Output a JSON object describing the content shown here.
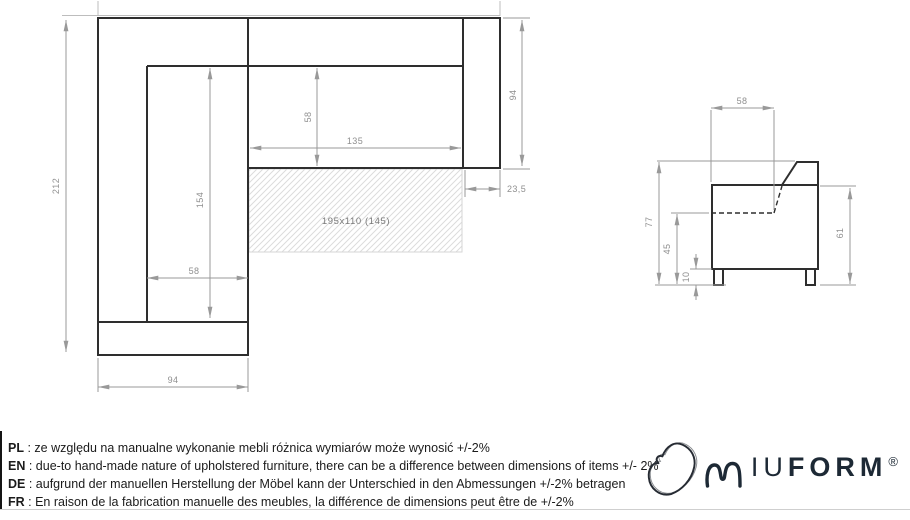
{
  "plan_view": {
    "dim_total_length": "212",
    "dim_chaise_width": "94",
    "dim_chaise_seat_width": "58",
    "dim_chaise_seat_length": "154",
    "dim_seat_width": "135",
    "dim_seat_depth": "58",
    "dim_body_depth": "94",
    "dim_armrest_width": "23,5",
    "sleeping_area_label": "195x110 (145)"
  },
  "side_view": {
    "dim_seat_top_depth": "58",
    "dim_total_height": "77",
    "dim_seat_height": "45",
    "dim_leg_height": "10",
    "dim_arm_height": "61"
  },
  "notes_separator": " : ",
  "notes": [
    {
      "code": "PL",
      "text": "ze względu na manualne wykonanie mebli różnica wymiarów może wynosić +/-2%"
    },
    {
      "code": "EN",
      "text": "due-to hand-made nature of upholstered furniture, there can be a difference between dimensions of items +/- 2%"
    },
    {
      "code": "DE",
      "text": "aufgrund der manuellen Herstellung der Möbel kann der Unterschied in den Abmessungen +/-2% betragen"
    },
    {
      "code": "FR",
      "text": "En raison de la fabrication manuelle des meubles, la différence de dimensions peut être de +/-2%"
    }
  ],
  "logo": {
    "letters_light": "IU",
    "letters_bold": "FORM",
    "registered": "®"
  },
  "colors": {
    "outline": "#2e2e2e",
    "dimension": "#8f8f8f",
    "brand": "#1d2935",
    "hatch": "#dcdcdc"
  }
}
